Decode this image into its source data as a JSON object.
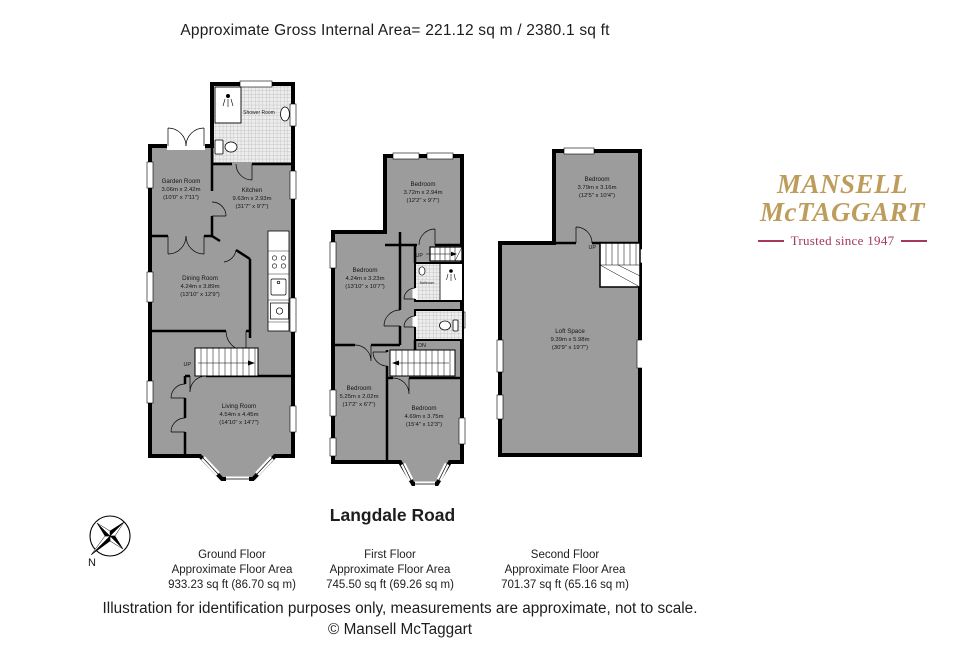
{
  "header": {
    "title": "Approximate Gross Internal Area= 221.12 sq m / 2380.1 sq ft"
  },
  "logo": {
    "name_line1": "MANSELL",
    "name_line2": "McTAGGART",
    "tagline": "Trusted since 1947",
    "gold_color": "#BE9D5C",
    "maroon_color": "#A43A58"
  },
  "property_name": "Langdale Road",
  "compass_label": "N",
  "colors": {
    "room_fill": "#9C9C9C",
    "wall": "#000000",
    "background": "#FFFFFF"
  },
  "floors": [
    {
      "name": "Ground Floor",
      "area_label": "Approximate Floor Area",
      "area_value": "933.23 sq ft (86.70 sq m)",
      "stair_label": "UP",
      "rooms": [
        {
          "name": "Shower Room"
        },
        {
          "name": "Garden Room",
          "dims_m": "3.06m x 2.42m",
          "dims_ft": "(10'0\" x 7'11\")"
        },
        {
          "name": "Kitchen",
          "dims_m": "9.63m x 2.93m",
          "dims_ft": "(31'7\" x 9'7\")"
        },
        {
          "name": "Dining Room",
          "dims_m": "4.24m x 3.89m",
          "dims_ft": "(13'10\" x 12'9\")"
        },
        {
          "name": "Living Room",
          "dims_m": "4.54m x 4.45m",
          "dims_ft": "(14'10\" x 14'7\")"
        }
      ]
    },
    {
      "name": "First Floor",
      "area_label": "Approximate Floor Area",
      "area_value": "745.50 sq ft (69.26 sq m)",
      "up_label": "UP",
      "down_label": "DN",
      "rooms": [
        {
          "name": "Bedroom",
          "dims_m": "3.72m x 2.94m",
          "dims_ft": "(12'2\" x 9'7\")"
        },
        {
          "name": "Bedroom",
          "dims_m": "4.24m x 3.23m",
          "dims_ft": "(13'10\" x 10'7\")"
        },
        {
          "name": "Bathroom"
        },
        {
          "name": "Bedroom",
          "dims_m": "5.25m x 2.02m",
          "dims_ft": "(17'2\" x 6'7\")"
        },
        {
          "name": "Bedroom",
          "dims_m": "4.69m x 3.75m",
          "dims_ft": "(15'4\" x 12'3\")"
        }
      ]
    },
    {
      "name": "Second Floor",
      "area_label": "Approximate Floor Area",
      "area_value": "701.37 sq ft (65.16 sq m)",
      "up_label": "UP",
      "rooms": [
        {
          "name": "Bedroom",
          "dims_m": "3.79m x 3.16m",
          "dims_ft": "(12'5\" x 10'4\")"
        },
        {
          "name": "Loft Space",
          "dims_m": "9.39m x 5.98m",
          "dims_ft": "(30'9\" x 19'7\")"
        }
      ]
    }
  ],
  "footer": {
    "disclaimer": "Illustration for identification purposes only, measurements are approximate, not to scale.",
    "copyright": "© Mansell McTaggart"
  }
}
